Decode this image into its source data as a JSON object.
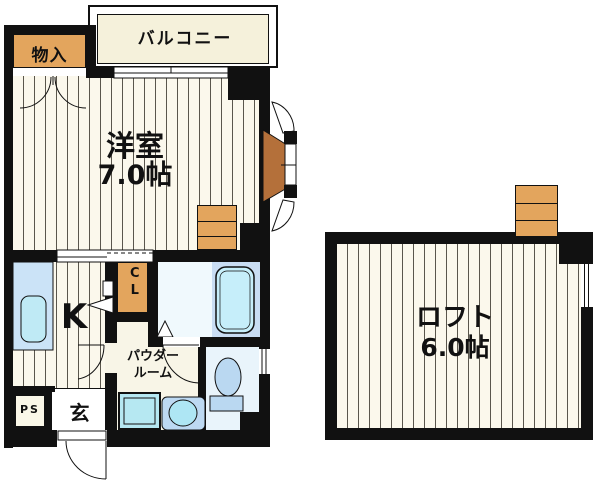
{
  "plan": {
    "balcony": {
      "label": "バルコニー"
    },
    "storage": {
      "label": "物入"
    },
    "western_room": {
      "label": "洋室",
      "size": "7.0帖"
    },
    "kitchen": {
      "label": "K"
    },
    "closet": {
      "label": "CL"
    },
    "powder_room": {
      "label": "パウダールーム"
    },
    "entrance": {
      "label": "玄"
    },
    "pipe_space": {
      "label": "PS"
    },
    "loft": {
      "label": "ロフト",
      "size": "6.0帖"
    }
  },
  "colors": {
    "wall": "#111111",
    "floor_cream": "#FBF8EC",
    "balcony_cream": "#F5F1DB",
    "storage_orange": "#E3A55D",
    "bay_brown": "#B4703A",
    "counter_blue": "#CBE3F7",
    "sink_cyan": "#BFEAF5",
    "tub_zone_blue": "#C9DDF3",
    "tub_cyan": "#C6EEFA",
    "toilet_floor_blue": "#E9F4FB",
    "fixture_blue": "#BAD8F1"
  }
}
